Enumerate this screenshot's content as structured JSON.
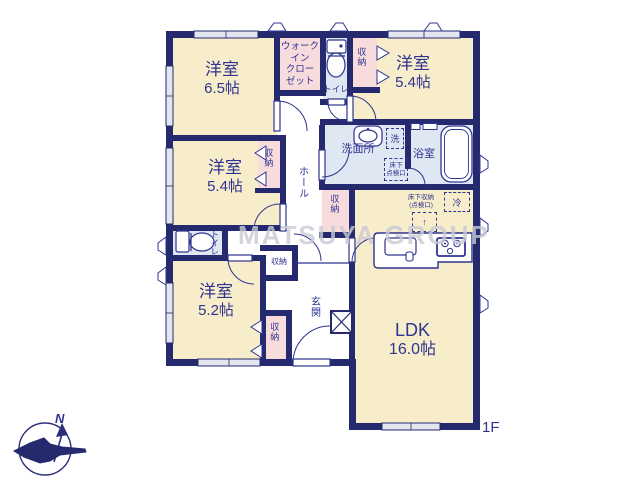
{
  "meta": {
    "floor_label": "1F",
    "watermark": "MATSUYA GROUP",
    "compass_north_label": "N"
  },
  "colors": {
    "wall_navy": "#252a6e",
    "label_navy": "#2e3490",
    "room_cream": "#f8edcb",
    "closet_pink": "#f8dbdc",
    "wet_area_blue": "#dfe7f3",
    "window_light": "#e3e5f0",
    "watermark_gray": "#c9cad4"
  },
  "rooms": {
    "yoshitsu_65": {
      "name": "洋室",
      "size": "6.5帖"
    },
    "wic": {
      "line1": "ウォーク",
      "line2": "イン",
      "line3": "クロー",
      "line4": "ゼット"
    },
    "toilet_upper": {
      "label": "トイレ"
    },
    "closet_top_right": {
      "label": "収納"
    },
    "yoshitsu_54_right": {
      "name": "洋室",
      "size": "5.4帖"
    },
    "washroom": {
      "label": "洗面所"
    },
    "bathroom": {
      "label": "浴室"
    },
    "yoshitsu_54_left": {
      "name": "洋室",
      "size": "5.4帖"
    },
    "closet_left_room": {
      "label": "収納"
    },
    "hall": {
      "label": "ホール"
    },
    "closet_mid": {
      "label": "収納"
    },
    "ldk": {
      "name": "LDK",
      "size": "16.0帖"
    },
    "toilet_lower": {
      "label": "トイレ"
    },
    "closet_small": {
      "label": "収納"
    },
    "yoshitsu_52": {
      "name": "洋室",
      "size": "5.2帖"
    },
    "closet_bottom": {
      "label": "収納"
    },
    "genkan": {
      "label": "玄関"
    }
  },
  "annotations": {
    "laundry": "洗",
    "underfloor_hatch_line1": "床下",
    "underfloor_hatch_line2": "点検口",
    "fridge": "冷",
    "underfloor_storage_line1": "床下収納",
    "underfloor_storage_line2": "(点検口)",
    "arrow_up": "↑"
  }
}
